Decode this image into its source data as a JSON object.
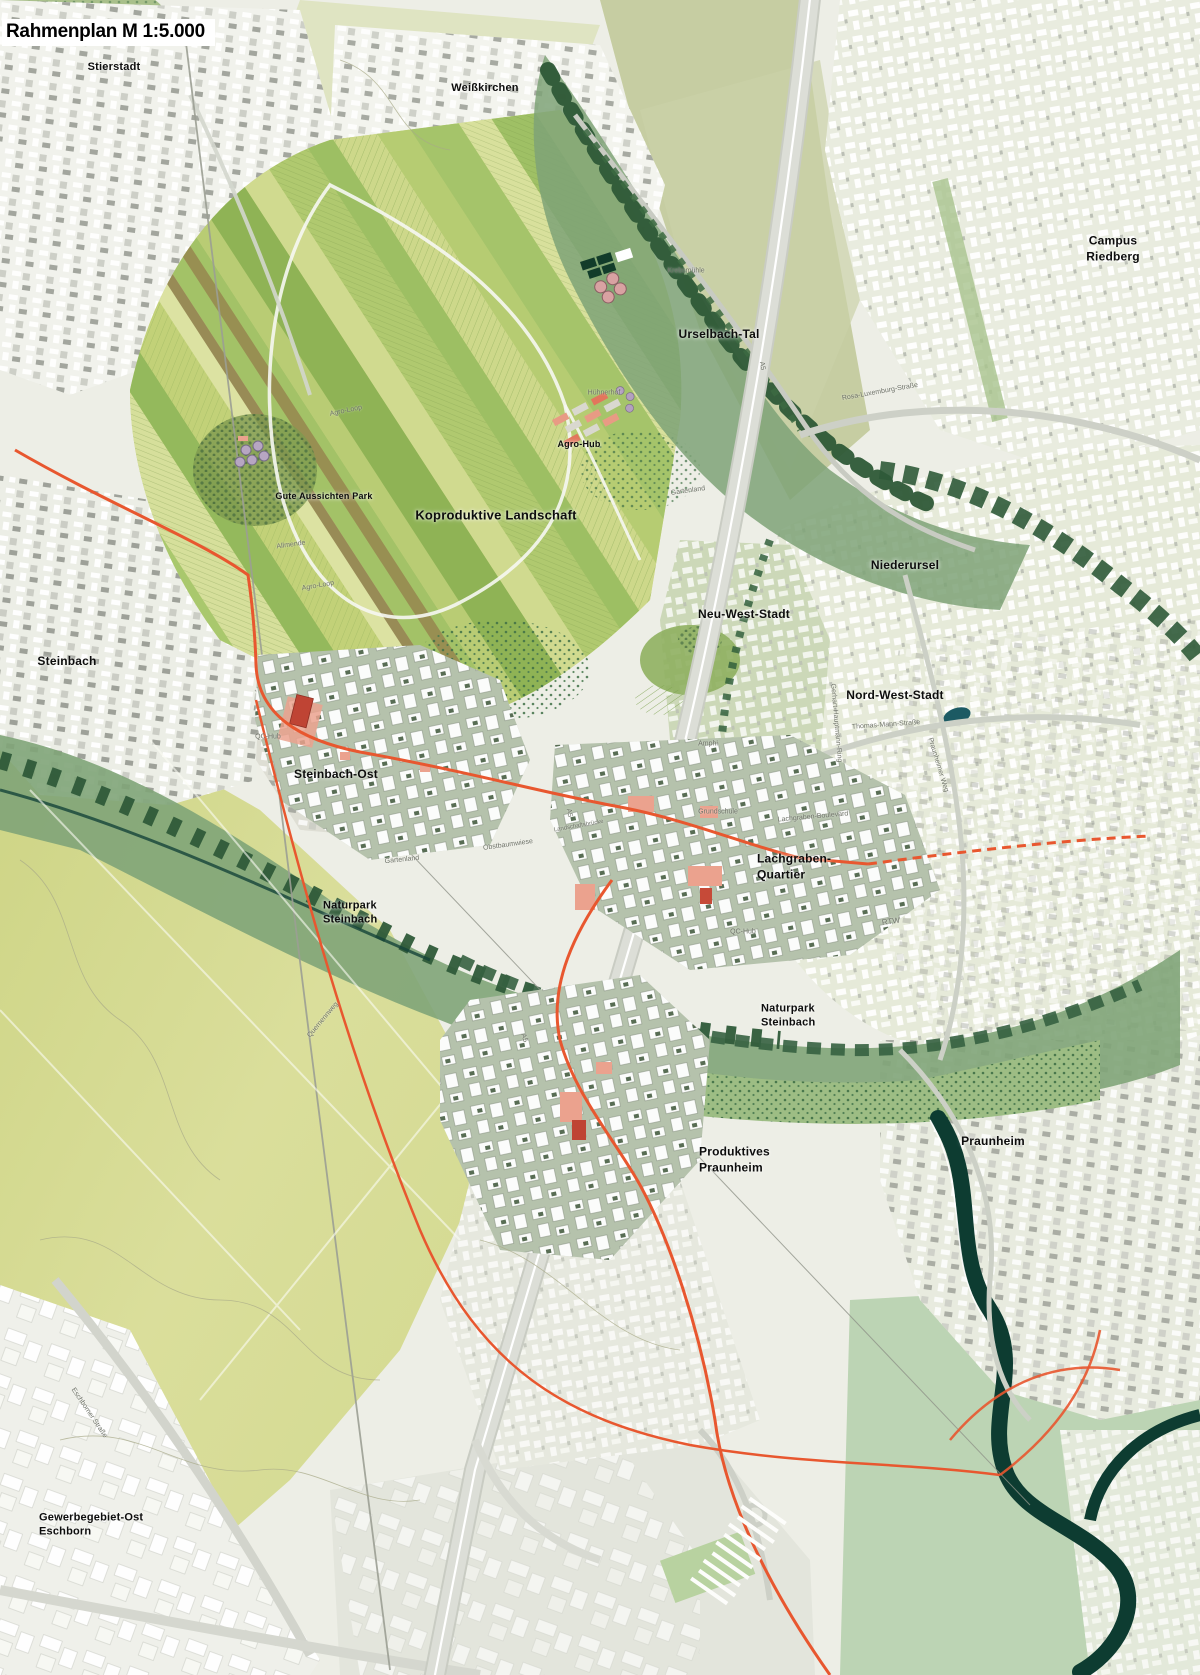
{
  "title": "Rahmenplan M 1:5.000",
  "map": {
    "scale": "1:5.000",
    "palette": {
      "paper": "#eef0e7",
      "urban-light": "#f2f3ed",
      "urban-green": "#e7ebdc",
      "olive-fields": "#c6cda2",
      "yellow-green": "#d7dc95",
      "field-green": "#c3d17c",
      "quarter-sage": "#b5c2ac",
      "valley-green": "#7fa478",
      "tree-dark": "#2f5a39",
      "river-teal": "#0d3c31",
      "highway-gray": "#d8dad2",
      "rtw-orange": "#e8572f",
      "salmon": "#eba28e",
      "red-accent": "#bf4434",
      "label-black": "#0d0d0d",
      "label-gray": "#6e7268"
    },
    "labels": [
      {
        "id": "stierstadt",
        "text": "Stierstadt",
        "x": 114,
        "y": 67,
        "type": "place",
        "size": 11
      },
      {
        "id": "weisskirchen",
        "text": "Weißkirchen",
        "x": 485,
        "y": 88,
        "type": "place",
        "size": 11
      },
      {
        "id": "campus-riedberg",
        "text": "Campus Riedberg",
        "x": 1113,
        "y": 249,
        "type": "place",
        "size": 12
      },
      {
        "id": "urselbach-tal",
        "text": "Urselbach-Tal",
        "x": 719,
        "y": 335,
        "type": "place",
        "size": 12
      },
      {
        "id": "agro-hub",
        "text": "Agro-Hub",
        "x": 579,
        "y": 445,
        "type": "place",
        "size": 9
      },
      {
        "id": "gute-aussichten-park",
        "text": "Gute Aussichten Park",
        "x": 324,
        "y": 497,
        "type": "place",
        "size": 9
      },
      {
        "id": "koproduktive-landschaft",
        "text": "Koproduktive Landschaft",
        "x": 496,
        "y": 516,
        "type": "place",
        "size": 13
      },
      {
        "id": "niederursel",
        "text": "Niederursel",
        "x": 905,
        "y": 566,
        "type": "place",
        "size": 12
      },
      {
        "id": "neu-west-stadt",
        "text": "Neu-West-Stadt",
        "x": 744,
        "y": 615,
        "type": "place",
        "size": 12
      },
      {
        "id": "nord-west-stadt",
        "text": "Nord-West-Stadt",
        "x": 895,
        "y": 696,
        "type": "place",
        "size": 12
      },
      {
        "id": "steinbach",
        "text": "Steinbach",
        "x": 67,
        "y": 662,
        "type": "place",
        "size": 12
      },
      {
        "id": "steinbach-ost",
        "text": "Steinbach-Ost",
        "x": 336,
        "y": 775,
        "type": "place",
        "size": 12
      },
      {
        "id": "lachgraben-quartier",
        "text": "Lachgraben-\nQuartier",
        "x": 757,
        "y": 867,
        "type": "place",
        "size": 12,
        "align": "left"
      },
      {
        "id": "naturpark-steinbach-west",
        "text": "Naturpark\nSteinbach",
        "x": 323,
        "y": 913,
        "type": "place",
        "size": 11,
        "align": "left"
      },
      {
        "id": "naturpark-steinbach-ost",
        "text": "Naturpark\nSteinbach",
        "x": 761,
        "y": 1016,
        "type": "place",
        "size": 11,
        "align": "left"
      },
      {
        "id": "produktives-praunheim",
        "text": "Produktives\nPraunheim",
        "x": 699,
        "y": 1160,
        "type": "place",
        "size": 12,
        "align": "left"
      },
      {
        "id": "praunheim",
        "text": "Praunheim",
        "x": 993,
        "y": 1142,
        "type": "place",
        "size": 12
      },
      {
        "id": "gewerbegebiet-ost-eschborn",
        "text": "Gewerbegebiet-Ost\nEschborn",
        "x": 39,
        "y": 1525,
        "type": "place",
        "size": 11,
        "align": "left"
      },
      {
        "id": "krebsmuehle",
        "text": "Krebsmühle",
        "x": 686,
        "y": 271,
        "type": "street",
        "size": 7
      },
      {
        "id": "huehnerhof",
        "text": "Hühnerhof",
        "x": 604,
        "y": 393,
        "type": "street",
        "size": 7
      },
      {
        "id": "agro-loop-1",
        "text": "Agro-Loop",
        "x": 346,
        "y": 411,
        "type": "street",
        "size": 7,
        "rot": -12
      },
      {
        "id": "agro-loop-2",
        "text": "Agro-Loop",
        "x": 318,
        "y": 586,
        "type": "street",
        "size": 7,
        "rot": -10
      },
      {
        "id": "allmende",
        "text": "Allmende",
        "x": 291,
        "y": 545,
        "type": "street",
        "size": 7,
        "rot": -8
      },
      {
        "id": "gartenland-1",
        "text": "Gartenland",
        "x": 688,
        "y": 491,
        "type": "street",
        "size": 7,
        "rot": -8
      },
      {
        "id": "gartenland-2",
        "text": "Gartenland",
        "x": 402,
        "y": 860,
        "type": "street",
        "size": 7,
        "rot": -6
      },
      {
        "id": "obstbaumwiese",
        "text": "Obstbaumwiese",
        "x": 508,
        "y": 845,
        "type": "street",
        "size": 7,
        "rot": -8
      },
      {
        "id": "rosa-luxemburg-strasse",
        "text": "Rosa-Luxemburg-Straße",
        "x": 880,
        "y": 392,
        "type": "street",
        "size": 7,
        "rot": -10
      },
      {
        "id": "thomas-mann-strasse",
        "text": "Thomas-Mann-Straße",
        "x": 886,
        "y": 725,
        "type": "street",
        "size": 7,
        "rot": -4
      },
      {
        "id": "gerhart-hauptmann-ring",
        "text": "Gerhart-Hauptmann-Ring",
        "x": 836,
        "y": 723,
        "type": "street",
        "size": 7,
        "rot": 85
      },
      {
        "id": "praunheimer-weg",
        "text": "Praunheimer Weg",
        "x": 938,
        "y": 765,
        "type": "street",
        "size": 7,
        "rot": 73
      },
      {
        "id": "grundschule",
        "text": "Grundschule",
        "x": 718,
        "y": 812,
        "type": "street",
        "size": 7
      },
      {
        "id": "lachgraben-boulevard",
        "text": "Lachgraben-Boulevard",
        "x": 813,
        "y": 817,
        "type": "street",
        "size": 7,
        "rot": -5
      },
      {
        "id": "rtw",
        "text": "RTW",
        "x": 891,
        "y": 922,
        "type": "street",
        "size": 8,
        "rot": -8
      },
      {
        "id": "a5-nord",
        "text": "A5",
        "x": 762,
        "y": 366,
        "type": "street",
        "size": 7,
        "rot": 80
      },
      {
        "id": "a5-mitte",
        "text": "A5",
        "x": 569,
        "y": 813,
        "type": "street",
        "size": 7,
        "rot": 78
      },
      {
        "id": "a5-sued",
        "text": "A5",
        "x": 524,
        "y": 1038,
        "type": "street",
        "size": 7,
        "rot": 72
      },
      {
        "id": "landschaftsbruecke",
        "text": "Landschaftsbrücke",
        "x": 579,
        "y": 827,
        "type": "street",
        "size": 6,
        "rot": -10
      },
      {
        "id": "quernennweg",
        "text": "Quernennweg",
        "x": 323,
        "y": 1020,
        "type": "street",
        "size": 7,
        "rot": -50
      },
      {
        "id": "eschborner-strasse",
        "text": "Eschborner Straße",
        "x": 89,
        "y": 1413,
        "type": "street",
        "size": 7,
        "rot": 56
      },
      {
        "id": "amphi",
        "text": "Amphi",
        "x": 708,
        "y": 744,
        "type": "street",
        "size": 7
      },
      {
        "id": "qc-hub-steinbach-ost",
        "text": "QC-Hub",
        "x": 268,
        "y": 737,
        "type": "street",
        "size": 7
      },
      {
        "id": "qc-hub-lachgraben",
        "text": "QC-Hub",
        "x": 743,
        "y": 932,
        "type": "street",
        "size": 7
      }
    ]
  }
}
